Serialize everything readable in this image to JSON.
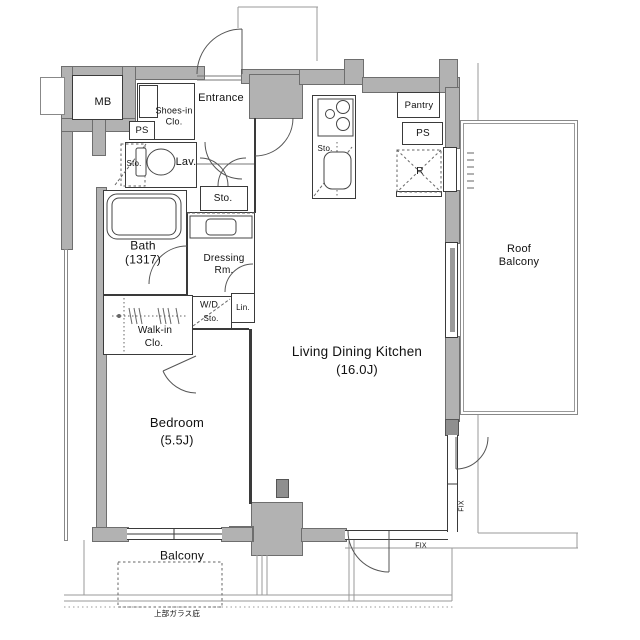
{
  "floorplan": {
    "rooms": {
      "mb": {
        "label": "MB"
      },
      "ps_left": {
        "label": "PS"
      },
      "shoes_closet": {
        "line1": "Shoes-in",
        "line2": "Clo."
      },
      "entrance": {
        "label": "Entrance"
      },
      "toilet": {
        "storage": "Sto.",
        "lav": "Lav."
      },
      "hall_storage": {
        "label": "Sto."
      },
      "bath": {
        "name": "Bath",
        "size": "(1317)"
      },
      "dressing": {
        "line1": "Dressing",
        "line2": "Rm."
      },
      "washer": {
        "line1": "W/D",
        "line2": "Sto."
      },
      "linen": {
        "label": "Lin."
      },
      "walkin": {
        "line1": "Walk-in",
        "line2": "Clo."
      },
      "bedroom": {
        "name": "Bedroom",
        "size": "(5.5J)"
      },
      "ldk": {
        "name": "Living Dining Kitchen",
        "size": "(16.0J)"
      },
      "kitchen_storage": {
        "label": "Sto."
      },
      "pantry": {
        "label": "Pantry"
      },
      "ps_right": {
        "label": "PS"
      },
      "fridge": {
        "label": "R"
      },
      "roof_balcony": {
        "line1": "Roof",
        "line2": "Balcony"
      },
      "balcony": {
        "label": "Balcony"
      }
    },
    "annotations": {
      "fix_right": "FIX",
      "fix_bottom": "FIX",
      "glass_canopy": "上部ガラス庇"
    },
    "colors": {
      "wall": "#b2b2b2",
      "wall_dark": "#8f8f8f",
      "line": "#3a3a3a",
      "boundary": "#999999",
      "text": "#111111"
    }
  }
}
